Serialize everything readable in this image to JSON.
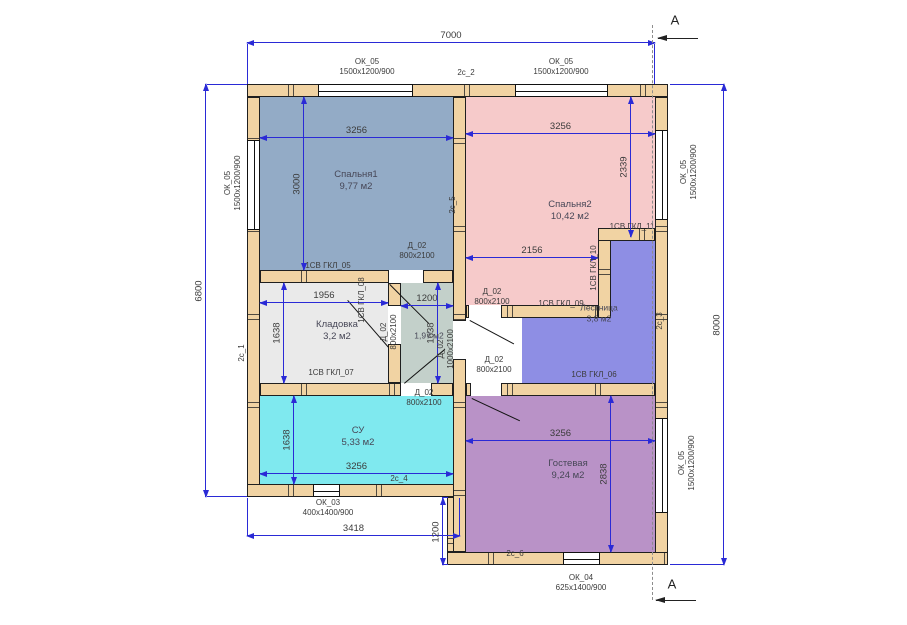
{
  "watermark": "HotWell.kz",
  "section_label": "А",
  "overall": {
    "width_top": "7000",
    "height_left": "6800",
    "height_right": "8000",
    "width_bottom_left": "3418",
    "step_bottom": "1200"
  },
  "rooms": {
    "bedroom1": {
      "name": "Спальня1",
      "area": "9,77 м2",
      "width": "3256",
      "height": "3000"
    },
    "bedroom2": {
      "name": "Спальня2",
      "area": "10,42 м2",
      "width": "3256",
      "height": "2339",
      "width_lower": "2156"
    },
    "storage": {
      "name": "Кладовка",
      "area": "3,2 м2",
      "width": "1956",
      "height": "1638"
    },
    "hall_entry": {
      "area": "1,97 м2",
      "width": "1200",
      "height": "1638"
    },
    "stairs": {
      "name": "Лестница",
      "area": "3,8 м2"
    },
    "bathroom": {
      "name": "СУ",
      "area": "5,33 м2",
      "width": "3256",
      "height": "1638"
    },
    "living": {
      "name": "Гостевая",
      "area": "9,24 м2",
      "width": "3256",
      "height": "2838"
    }
  },
  "windows": {
    "ok05": {
      "code": "ОК_05",
      "size": "1500х1200/900"
    },
    "ok03": {
      "code": "ОК_03",
      "size": "400х1400/900"
    },
    "ok04": {
      "code": "ОК_04",
      "size": "625х1400/900"
    }
  },
  "doors": {
    "d800": {
      "code": "Д_02",
      "size": "800х2100"
    },
    "d1000": {
      "code": "Д_02",
      "size": "1000х2100"
    }
  },
  "wall_tags": {
    "t05": "1СВ ГКЛ_05",
    "t06": "1СВ ГКЛ_06",
    "t07": "1СВ ГКЛ_07",
    "t08": "1СВ ГКЛ_08",
    "t09": "1СВ ГКЛ_09",
    "t10": "1СВ ГКЛ_10",
    "t11": "1СВ ГКЛ_11"
  },
  "axis_tags": {
    "c1": "2с_1",
    "c2": "2с_2",
    "c3": "2с_3",
    "c4": "2с_4",
    "c5": "2с_5",
    "c6": "2с_6"
  },
  "colors": {
    "wall": "#f1d3a3",
    "bedroom1": "#93abc6",
    "bedroom2": "#f6caca",
    "storage": "#eaeaea",
    "hall_entry": "#c3d0ca",
    "stairs": "#8e8ee4",
    "bathroom": "#7fe9ef",
    "living": "#b992c7",
    "dimension": "#2a2ad6"
  }
}
